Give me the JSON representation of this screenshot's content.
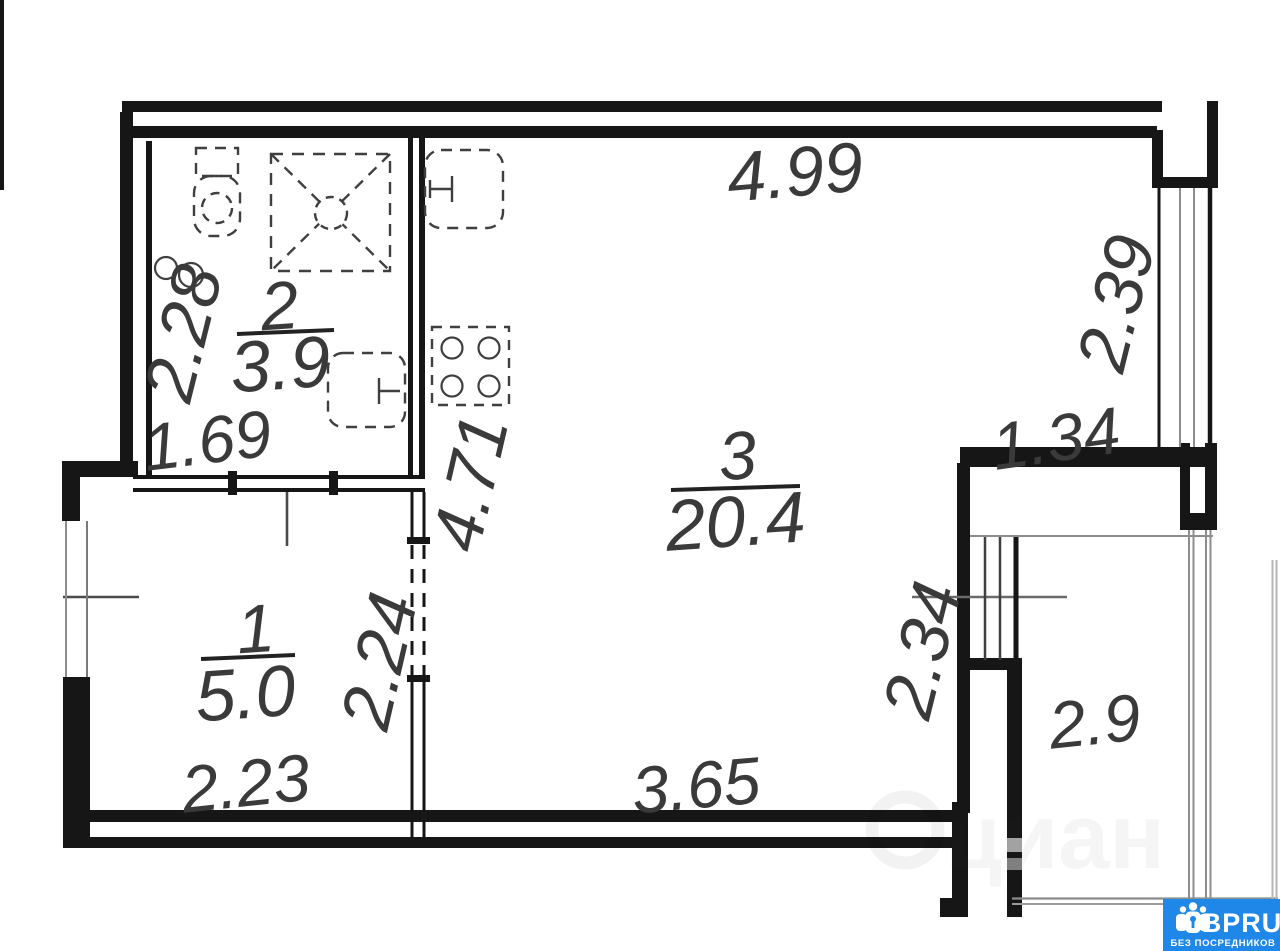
{
  "plan": {
    "rooms": {
      "hall": {
        "number": "1",
        "area": "5.0"
      },
      "bath": {
        "number": "2",
        "area": "3.9"
      },
      "living": {
        "number": "3",
        "area": "20.4"
      },
      "balcony": {
        "area": "2.9"
      }
    },
    "dims": {
      "top": "4.99",
      "right_window": "2.39",
      "right_pier": "1.34",
      "bath_h": "2.28",
      "bath_w": "1.69",
      "kitchen_h": "4.71",
      "hall_door": "2.24",
      "hall_w": "2.23",
      "living_w": "3.65",
      "balcony_door": "2.34"
    }
  },
  "watermarks": {
    "cian": "циан",
    "badge": {
      "brand": "BPRU",
      "tagline": "БЕЗ ПОСРЕДНИКОВ",
      "bg": "#1f87e8"
    }
  }
}
